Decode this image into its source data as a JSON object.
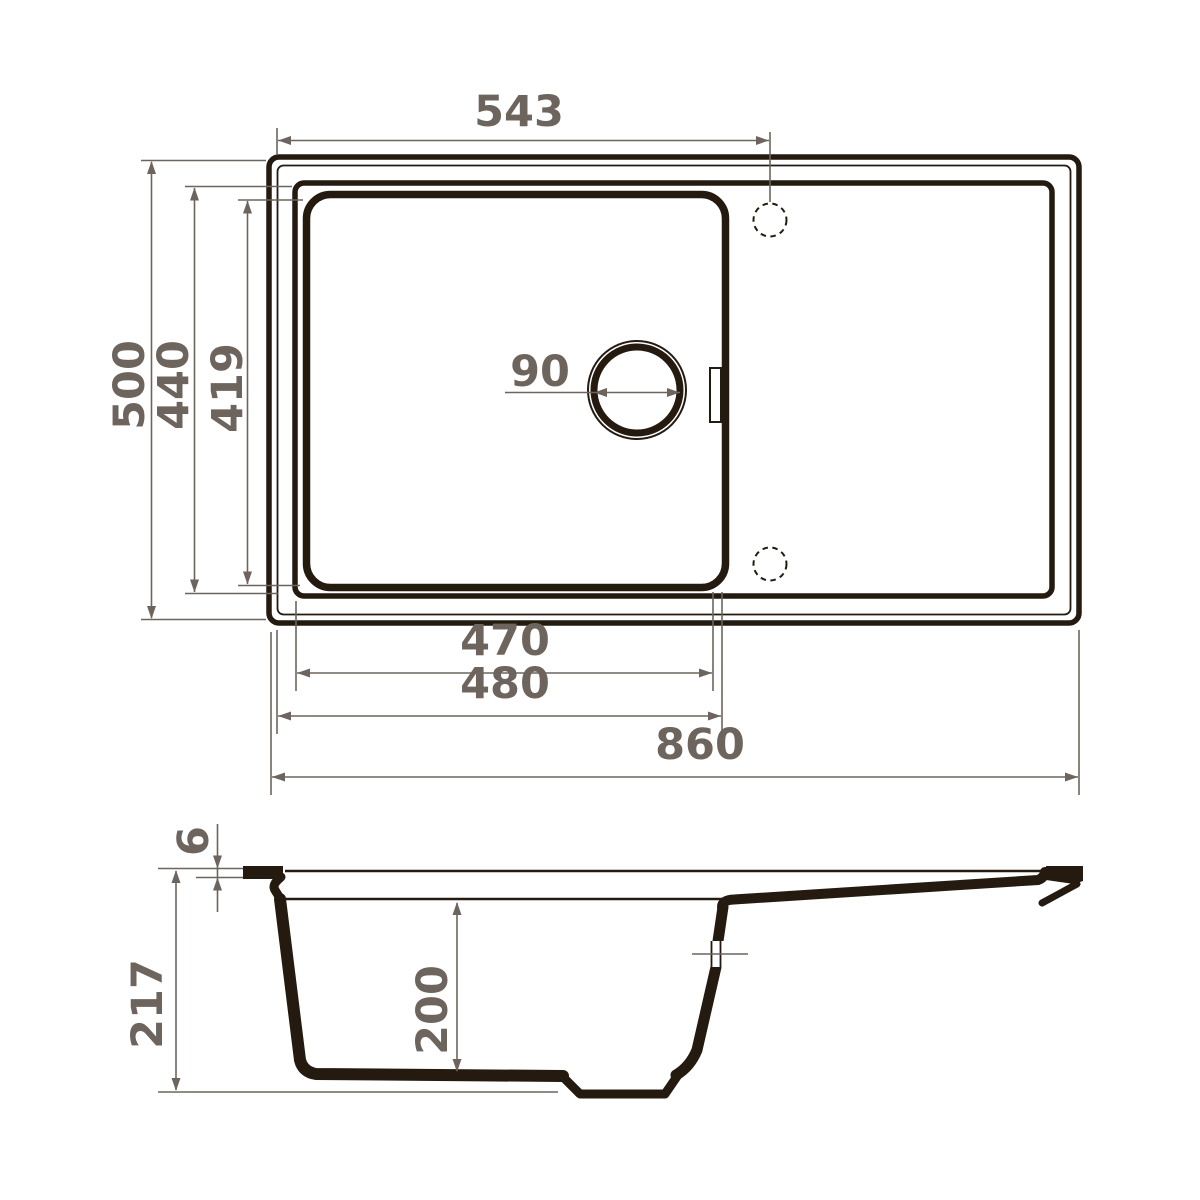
{
  "drawing": {
    "title": "Kitchen sink dimensional drawing",
    "views": {
      "top": "top-view",
      "side": "side-section-view"
    },
    "colors": {
      "ink": "#241a10",
      "dim": "#6d655d",
      "background": "#ffffff"
    },
    "dims": {
      "faucet_offset": "543",
      "overall_depth": "500",
      "rim_depth": "440",
      "bowl_depth_plan": "419",
      "drain_diameter": "90",
      "bowl_width_inner": "470",
      "bowl_width_outer": "480",
      "overall_width": "860",
      "rim_lip_height": "6",
      "total_height": "217",
      "bowl_depth_section": "200"
    }
  }
}
